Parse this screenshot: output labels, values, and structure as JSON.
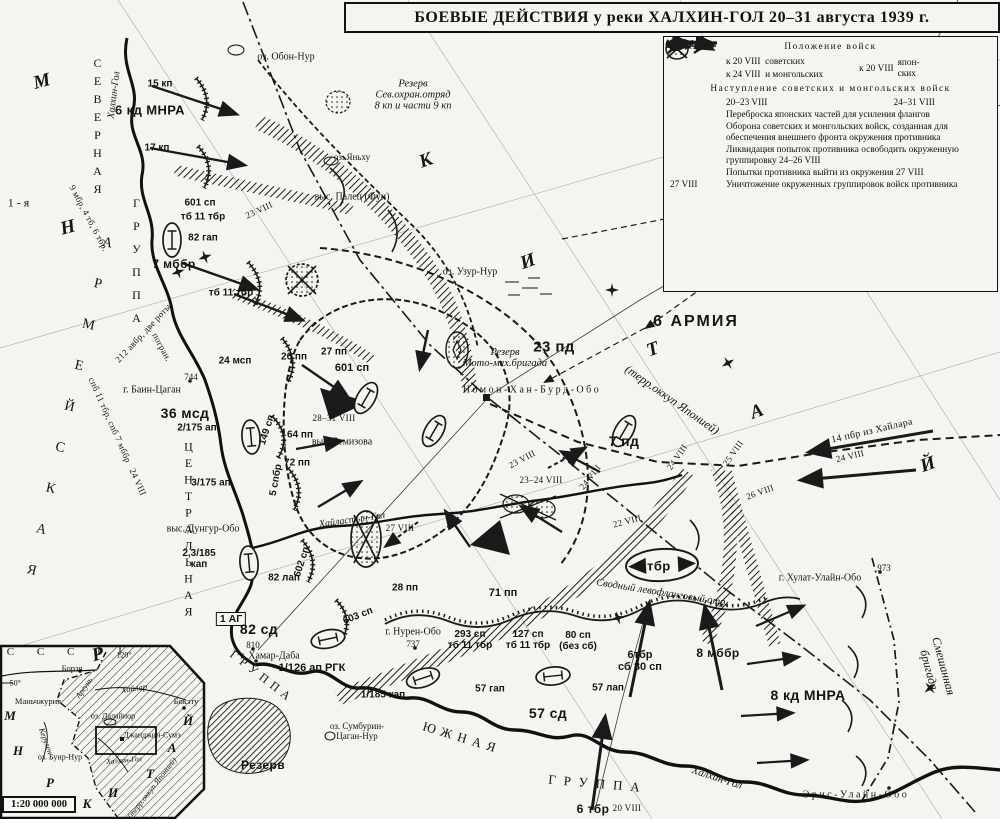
{
  "title": "БОЕВЫЕ ДЕЙСТВИЯ у реки ХАЛХИН-ГОЛ 20–31 августа 1939 г.",
  "legend": {
    "heading1": "Положение войск",
    "pos_sov_date1": "к 20 VIII",
    "pos_sov_label1": "советских",
    "pos_sov_date2": "к 24 VIII",
    "pos_sov_label2": "и монгольских",
    "pos_jap_date": "к 20 VIII",
    "pos_jap_label": "япон-\nских",
    "heading2": "Наступление советских и монгольских войск",
    "advance1": "20–23 VIII",
    "advance2": "24–31 VIII",
    "transfer": "Переброска японских частей для усиления флангов",
    "defense": "Оборона советских и монгольских войск, созданная для обеспечения внешнего фронта окружения противника",
    "liquidation": "Ликвидация попыток противника освободить окруженную группировку 24–26 VIII",
    "breakout": "Попытки противника выйти из окружения 27 VIII",
    "destruction_date": "27 VIII",
    "destruction": "Уничтожение окруженных группировок войск противника"
  },
  "map_labels": [
    {
      "t": "15 кп",
      "x": 160,
      "y": 84,
      "c": "u"
    },
    {
      "t": "6 кд МНРА",
      "x": 150,
      "y": 110,
      "c": "ub"
    },
    {
      "t": "17 кп",
      "x": 157,
      "y": 148,
      "c": "u"
    },
    {
      "t": "оз. Обон-Нур",
      "x": 286,
      "y": 57,
      "c": "t"
    },
    {
      "t": "Резерв\nСев.охран.отряд\n8 кп и части 9 кп",
      "x": 413,
      "y": 95,
      "c": "ti"
    },
    {
      "t": "оз. Яньху",
      "x": 352,
      "y": 157,
      "c": "t",
      "fs": 9
    },
    {
      "t": "Резерв",
      "x": 908,
      "y": 92,
      "c": "ti"
    },
    {
      "t": "Джанджин-Сумэ",
      "x": 872,
      "y": 170,
      "c": "tsp"
    },
    {
      "t": "выс. Палец (Фуи)",
      "x": 352,
      "y": 197,
      "c": "t"
    },
    {
      "t": "601 сп",
      "x": 200,
      "y": 203,
      "c": "u"
    },
    {
      "t": "тб 11 тбр",
      "x": 203,
      "y": 217,
      "c": "u"
    },
    {
      "t": "82 гап",
      "x": 203,
      "y": 238,
      "c": "u"
    },
    {
      "t": "23 VIII",
      "x": 259,
      "y": 210,
      "c": "d",
      "r": -25
    },
    {
      "t": "7 мббр",
      "x": 174,
      "y": 264,
      "c": "ub",
      "fs": 12
    },
    {
      "t": "тб 11 тбр",
      "x": 231,
      "y": 293,
      "c": "u"
    },
    {
      "t": "оз. Узур-Нур",
      "x": 470,
      "y": 272,
      "c": "t"
    },
    {
      "t": "М",
      "x": 42,
      "y": 82,
      "c": "bl",
      "r": -15
    },
    {
      "t": "Н",
      "x": 68,
      "y": 228,
      "c": "bl",
      "r": -15
    },
    {
      "t": "Р",
      "x": 98,
      "y": 655,
      "c": "bl",
      "r": -15
    },
    {
      "t": "К",
      "x": 426,
      "y": 161,
      "c": "bl",
      "r": -20
    },
    {
      "t": "И",
      "x": 528,
      "y": 262,
      "c": "bl",
      "r": -20
    },
    {
      "t": "Т",
      "x": 653,
      "y": 350,
      "c": "bl",
      "r": -20
    },
    {
      "t": "А",
      "x": 757,
      "y": 412,
      "c": "bl",
      "r": -20
    },
    {
      "t": "Й",
      "x": 928,
      "y": 465,
      "c": "bl",
      "r": -20
    },
    {
      "t": "СЕВЕРНАЯ",
      "x": 97,
      "y": 128,
      "c": "grp vstack",
      "fs": 12,
      "ls": 4
    },
    {
      "t": "ГРУППА",
      "x": 136,
      "y": 265,
      "c": "grp vstack",
      "fs": 12,
      "ls": 9
    },
    {
      "t": "1-я",
      "x": 20,
      "y": 203,
      "c": "grp",
      "fs": 12
    },
    {
      "t": "АРМЕЙСКАЯ",
      "x": 66,
      "y": 420,
      "c": "grp vstack",
      "r": 13,
      "fs": 14,
      "ls": 27
    },
    {
      "t": "ЦЕНТРАЛЬНАЯ",
      "x": 188,
      "y": 530,
      "c": "grp vstack",
      "fs": 12,
      "ls": 2.5
    },
    {
      "t": "ГРУППА",
      "x": 262,
      "y": 677,
      "c": "grp",
      "r": 38,
      "fs": 12,
      "ls": 5
    },
    {
      "t": "ЮЖНАЯ",
      "x": 462,
      "y": 738,
      "c": "grp",
      "r": 17,
      "fs": 13,
      "ls": 6
    },
    {
      "t": "ГРУППА",
      "x": 598,
      "y": 784,
      "c": "grp",
      "r": 5,
      "fs": 13,
      "ls": 8
    },
    {
      "t": "Халхин-Гол",
      "x": 114,
      "y": 95,
      "c": "ti",
      "r": -83,
      "fs": 10
    },
    {
      "t": "Хайластын-Гол",
      "x": 352,
      "y": 520,
      "c": "ti",
      "r": -8,
      "fs": 10
    },
    {
      "t": "Халхин-Гол",
      "x": 717,
      "y": 778,
      "c": "ti",
      "r": 18,
      "fs": 11
    },
    {
      "t": "9 мбр, 4 тб, 6 тбр.",
      "x": 89,
      "y": 218,
      "c": "d",
      "r": 62
    },
    {
      "t": "спб 11 тбр, спб 7 мббр",
      "x": 110,
      "y": 420,
      "c": "d",
      "r": 66
    },
    {
      "t": "24 VIII",
      "x": 138,
      "y": 482,
      "c": "d",
      "r": 66
    },
    {
      "t": "212 авбр, две роты",
      "x": 143,
      "y": 333,
      "c": "d",
      "r": -47
    },
    {
      "t": "погран.",
      "x": 162,
      "y": 347,
      "c": "d",
      "r": 62
    },
    {
      "t": "24 мсп",
      "x": 235,
      "y": 361,
      "c": "u"
    },
    {
      "t": "744",
      "x": 191,
      "y": 377,
      "c": "t",
      "fs": 9
    },
    {
      "t": "г. Баин-Цаган",
      "x": 152,
      "y": 390,
      "c": "t"
    },
    {
      "t": "36 мсд",
      "x": 185,
      "y": 413,
      "c": "ub",
      "fs": 14
    },
    {
      "t": "2/175 ап",
      "x": 197,
      "y": 428,
      "c": "u"
    },
    {
      "t": "3/175 ап",
      "x": 211,
      "y": 483,
      "c": "u"
    },
    {
      "t": "26 пп",
      "x": 294,
      "y": 357,
      "c": "u"
    },
    {
      "t": "27 пп",
      "x": 334,
      "y": 352,
      "c": "u"
    },
    {
      "t": "601 сп",
      "x": 352,
      "y": 368,
      "c": "u",
      "fs": 11
    },
    {
      "t": "23 пд",
      "x": 554,
      "y": 347,
      "c": "ub",
      "fs": 15
    },
    {
      "t": "Резерв\nМото-мех.бригада",
      "x": 505,
      "y": 358,
      "c": "ti"
    },
    {
      "t": "6 АРМИЯ",
      "x": 696,
      "y": 322,
      "c": "ub",
      "fs": 16,
      "ls": 2
    },
    {
      "t": "(терр.оккуп Японией)",
      "x": 672,
      "y": 400,
      "c": "ti",
      "r": 35,
      "fs": 12
    },
    {
      "t": "Номон-Хан-Бурд-Обо",
      "x": 532,
      "y": 390,
      "c": "tsp"
    },
    {
      "t": "28–31 VIII",
      "x": 334,
      "y": 418,
      "c": "d"
    },
    {
      "t": "выс. Ремизова",
      "x": 342,
      "y": 442,
      "c": "t"
    },
    {
      "t": "64 пп",
      "x": 300,
      "y": 435,
      "c": "u"
    },
    {
      "t": "72 пп",
      "x": 297,
      "y": 463,
      "c": "u"
    },
    {
      "t": "149 сп",
      "x": 267,
      "y": 430,
      "c": "u",
      "r": -72
    },
    {
      "t": "5 спбр",
      "x": 276,
      "y": 480,
      "c": "u",
      "r": -80
    },
    {
      "t": "7 пд",
      "x": 624,
      "y": 441,
      "c": "ub",
      "fs": 14
    },
    {
      "t": "14 пбр из Хайлара",
      "x": 872,
      "y": 431,
      "c": "d",
      "r": -13,
      "fs": 10
    },
    {
      "t": "24 VIII",
      "x": 850,
      "y": 456,
      "c": "d",
      "r": -13
    },
    {
      "t": "24 VIII",
      "x": 677,
      "y": 457,
      "c": "d",
      "r": -55
    },
    {
      "t": "25 VIII",
      "x": 733,
      "y": 453,
      "c": "d",
      "r": -55
    },
    {
      "t": "26 VIII",
      "x": 760,
      "y": 492,
      "c": "d",
      "r": -20
    },
    {
      "t": "23 VIII",
      "x": 522,
      "y": 459,
      "c": "d",
      "r": -28
    },
    {
      "t": "23–24 VIII",
      "x": 541,
      "y": 480,
      "c": "d"
    },
    {
      "t": "24 VIII",
      "x": 590,
      "y": 477,
      "c": "d",
      "r": -52
    },
    {
      "t": "27 VIII",
      "x": 400,
      "y": 528,
      "c": "d"
    },
    {
      "t": "22 VIII",
      "x": 627,
      "y": 521,
      "c": "d",
      "r": -15
    },
    {
      "t": "6 тбр",
      "x": 653,
      "y": 566,
      "c": "ub",
      "fs": 13
    },
    {
      "t": "выс. Дунгур-Обо",
      "x": 203,
      "y": 529,
      "c": "t"
    },
    {
      "t": "2,3/185\nкап",
      "x": 199,
      "y": 559,
      "c": "u"
    },
    {
      "t": "82 лап",
      "x": 284,
      "y": 578,
      "c": "u"
    },
    {
      "t": "602 сп",
      "x": 302,
      "y": 562,
      "c": "u",
      "r": -72
    },
    {
      "t": "603 сп",
      "x": 358,
      "y": 616,
      "c": "u",
      "r": -22
    },
    {
      "t": "1 АГ",
      "x": 231,
      "y": 619,
      "c": "boxed",
      "n": "command-post-label"
    },
    {
      "t": "82 сд",
      "x": 259,
      "y": 629,
      "c": "ub",
      "fs": 14
    },
    {
      "t": "810",
      "x": 253,
      "y": 645,
      "c": "t",
      "fs": 9
    },
    {
      "t": "г. Хамар-Даба",
      "x": 270,
      "y": 656,
      "c": "t"
    },
    {
      "t": "1/126 ап РГК",
      "x": 312,
      "y": 668,
      "c": "u",
      "fs": 11
    },
    {
      "t": "1/185 кап",
      "x": 383,
      "y": 695,
      "c": "u"
    },
    {
      "t": "28 пп",
      "x": 405,
      "y": 588,
      "c": "u"
    },
    {
      "t": "71 пп",
      "x": 503,
      "y": 593,
      "c": "u",
      "fs": 11
    },
    {
      "t": "Сводный левофланговый отр.",
      "x": 662,
      "y": 593,
      "c": "ti",
      "r": 9,
      "fs": 10.5
    },
    {
      "t": "г. Нурен-Обо",
      "x": 413,
      "y": 632,
      "c": "t"
    },
    {
      "t": "737",
      "x": 413,
      "y": 644,
      "c": "t",
      "fs": 9
    },
    {
      "t": "293 сп\nтб 11 тбр",
      "x": 470,
      "y": 640,
      "c": "u"
    },
    {
      "t": "127 сп\nтб 11 тбр",
      "x": 528,
      "y": 640,
      "c": "u"
    },
    {
      "t": "80 сп\n(без сб)",
      "x": 578,
      "y": 641,
      "c": "u"
    },
    {
      "t": "6тбр\nсб 80 сп",
      "x": 640,
      "y": 661,
      "c": "u",
      "fs": 11
    },
    {
      "t": "8 мббр",
      "x": 718,
      "y": 653,
      "c": "ub",
      "fs": 12
    },
    {
      "t": "57 гап",
      "x": 490,
      "y": 689,
      "c": "u"
    },
    {
      "t": "57 лап",
      "x": 608,
      "y": 688,
      "c": "u"
    },
    {
      "t": "57 сд",
      "x": 548,
      "y": 713,
      "c": "ub",
      "fs": 14
    },
    {
      "t": "6 тбр",
      "x": 593,
      "y": 809,
      "c": "ub",
      "fs": 12
    },
    {
      "t": "20 VIII",
      "x": 627,
      "y": 808,
      "c": "d"
    },
    {
      "t": "Резерв",
      "x": 263,
      "y": 765,
      "c": "ub",
      "fs": 12
    },
    {
      "t": "оз. Сумбурин-\nЦаган-Нур",
      "x": 357,
      "y": 731,
      "c": "t",
      "fs": 9
    },
    {
      "t": "г. Хулат-Улайн-Обо",
      "x": 820,
      "y": 578,
      "c": "t"
    },
    {
      "t": "973",
      "x": 884,
      "y": 568,
      "c": "t",
      "fs": 9
    },
    {
      "t": "Смешанная бригада",
      "x": 936,
      "y": 668,
      "c": "ti",
      "r": 75,
      "fs": 12
    },
    {
      "t": "8 кд МНРА",
      "x": 808,
      "y": 695,
      "c": "ub",
      "fs": 14
    },
    {
      "t": "Эрис-Улайн-Обо",
      "x": 856,
      "y": 795,
      "c": "tsp"
    }
  ],
  "inset": {
    "scale": "1:20 000 000",
    "labels": [
      {
        "t": "С  С  С  Р",
        "x": 60,
        "y": 652,
        "c": "grp",
        "fs": 11,
        "ls": 10
      },
      {
        "t": "120°",
        "x": 124,
        "y": 655,
        "c": "t",
        "fs": 8
      },
      {
        "t": "Борзя",
        "x": 72,
        "y": 668,
        "c": "t",
        "fs": 8.5
      },
      {
        "t": "−50°",
        "x": 13,
        "y": 683,
        "c": "t",
        "fs": 8
      },
      {
        "t": "Маньчжурия",
        "x": 38,
        "y": 701,
        "c": "t",
        "fs": 8.5
      },
      {
        "t": "Хайлар",
        "x": 134,
        "y": 688,
        "c": "ti",
        "fs": 8.5,
        "r": -8
      },
      {
        "t": "Бокэту",
        "x": 186,
        "y": 701,
        "c": "t",
        "fs": 8.5
      },
      {
        "t": "оз. Далайнор",
        "x": 113,
        "y": 716,
        "c": "t",
        "fs": 8
      },
      {
        "t": "Джанджин-Сумэ",
        "x": 152,
        "y": 735,
        "c": "t",
        "fs": 8
      },
      {
        "t": "оз. Буир-Нур",
        "x": 60,
        "y": 757,
        "c": "t",
        "fs": 8
      },
      {
        "t": "Халхин-Гол",
        "x": 124,
        "y": 760,
        "c": "ti",
        "fs": 7.5,
        "r": -5
      },
      {
        "t": "Керулен",
        "x": 46,
        "y": 741,
        "c": "ti",
        "fs": 8,
        "r": 70
      },
      {
        "t": "Аргунь",
        "x": 84,
        "y": 688,
        "c": "ti",
        "fs": 8,
        "r": -55
      },
      {
        "t": "М",
        "x": 10,
        "y": 716,
        "c": "bl",
        "fs": 13
      },
      {
        "t": "Н",
        "x": 18,
        "y": 751,
        "c": "bl",
        "fs": 13
      },
      {
        "t": "Р",
        "x": 50,
        "y": 783,
        "c": "bl",
        "fs": 13
      },
      {
        "t": "К",
        "x": 87,
        "y": 804,
        "c": "bl",
        "fs": 13
      },
      {
        "t": "И",
        "x": 113,
        "y": 793,
        "c": "bl",
        "fs": 13
      },
      {
        "t": "Т",
        "x": 150,
        "y": 774,
        "c": "bl",
        "fs": 13
      },
      {
        "t": "А",
        "x": 172,
        "y": 748,
        "c": "bl",
        "fs": 13
      },
      {
        "t": "Й",
        "x": 188,
        "y": 721,
        "c": "bl",
        "fs": 13
      },
      {
        "t": "(терр.оккуп Японией)",
        "x": 152,
        "y": 788,
        "c": "ti",
        "fs": 8,
        "r": -52
      }
    ]
  }
}
